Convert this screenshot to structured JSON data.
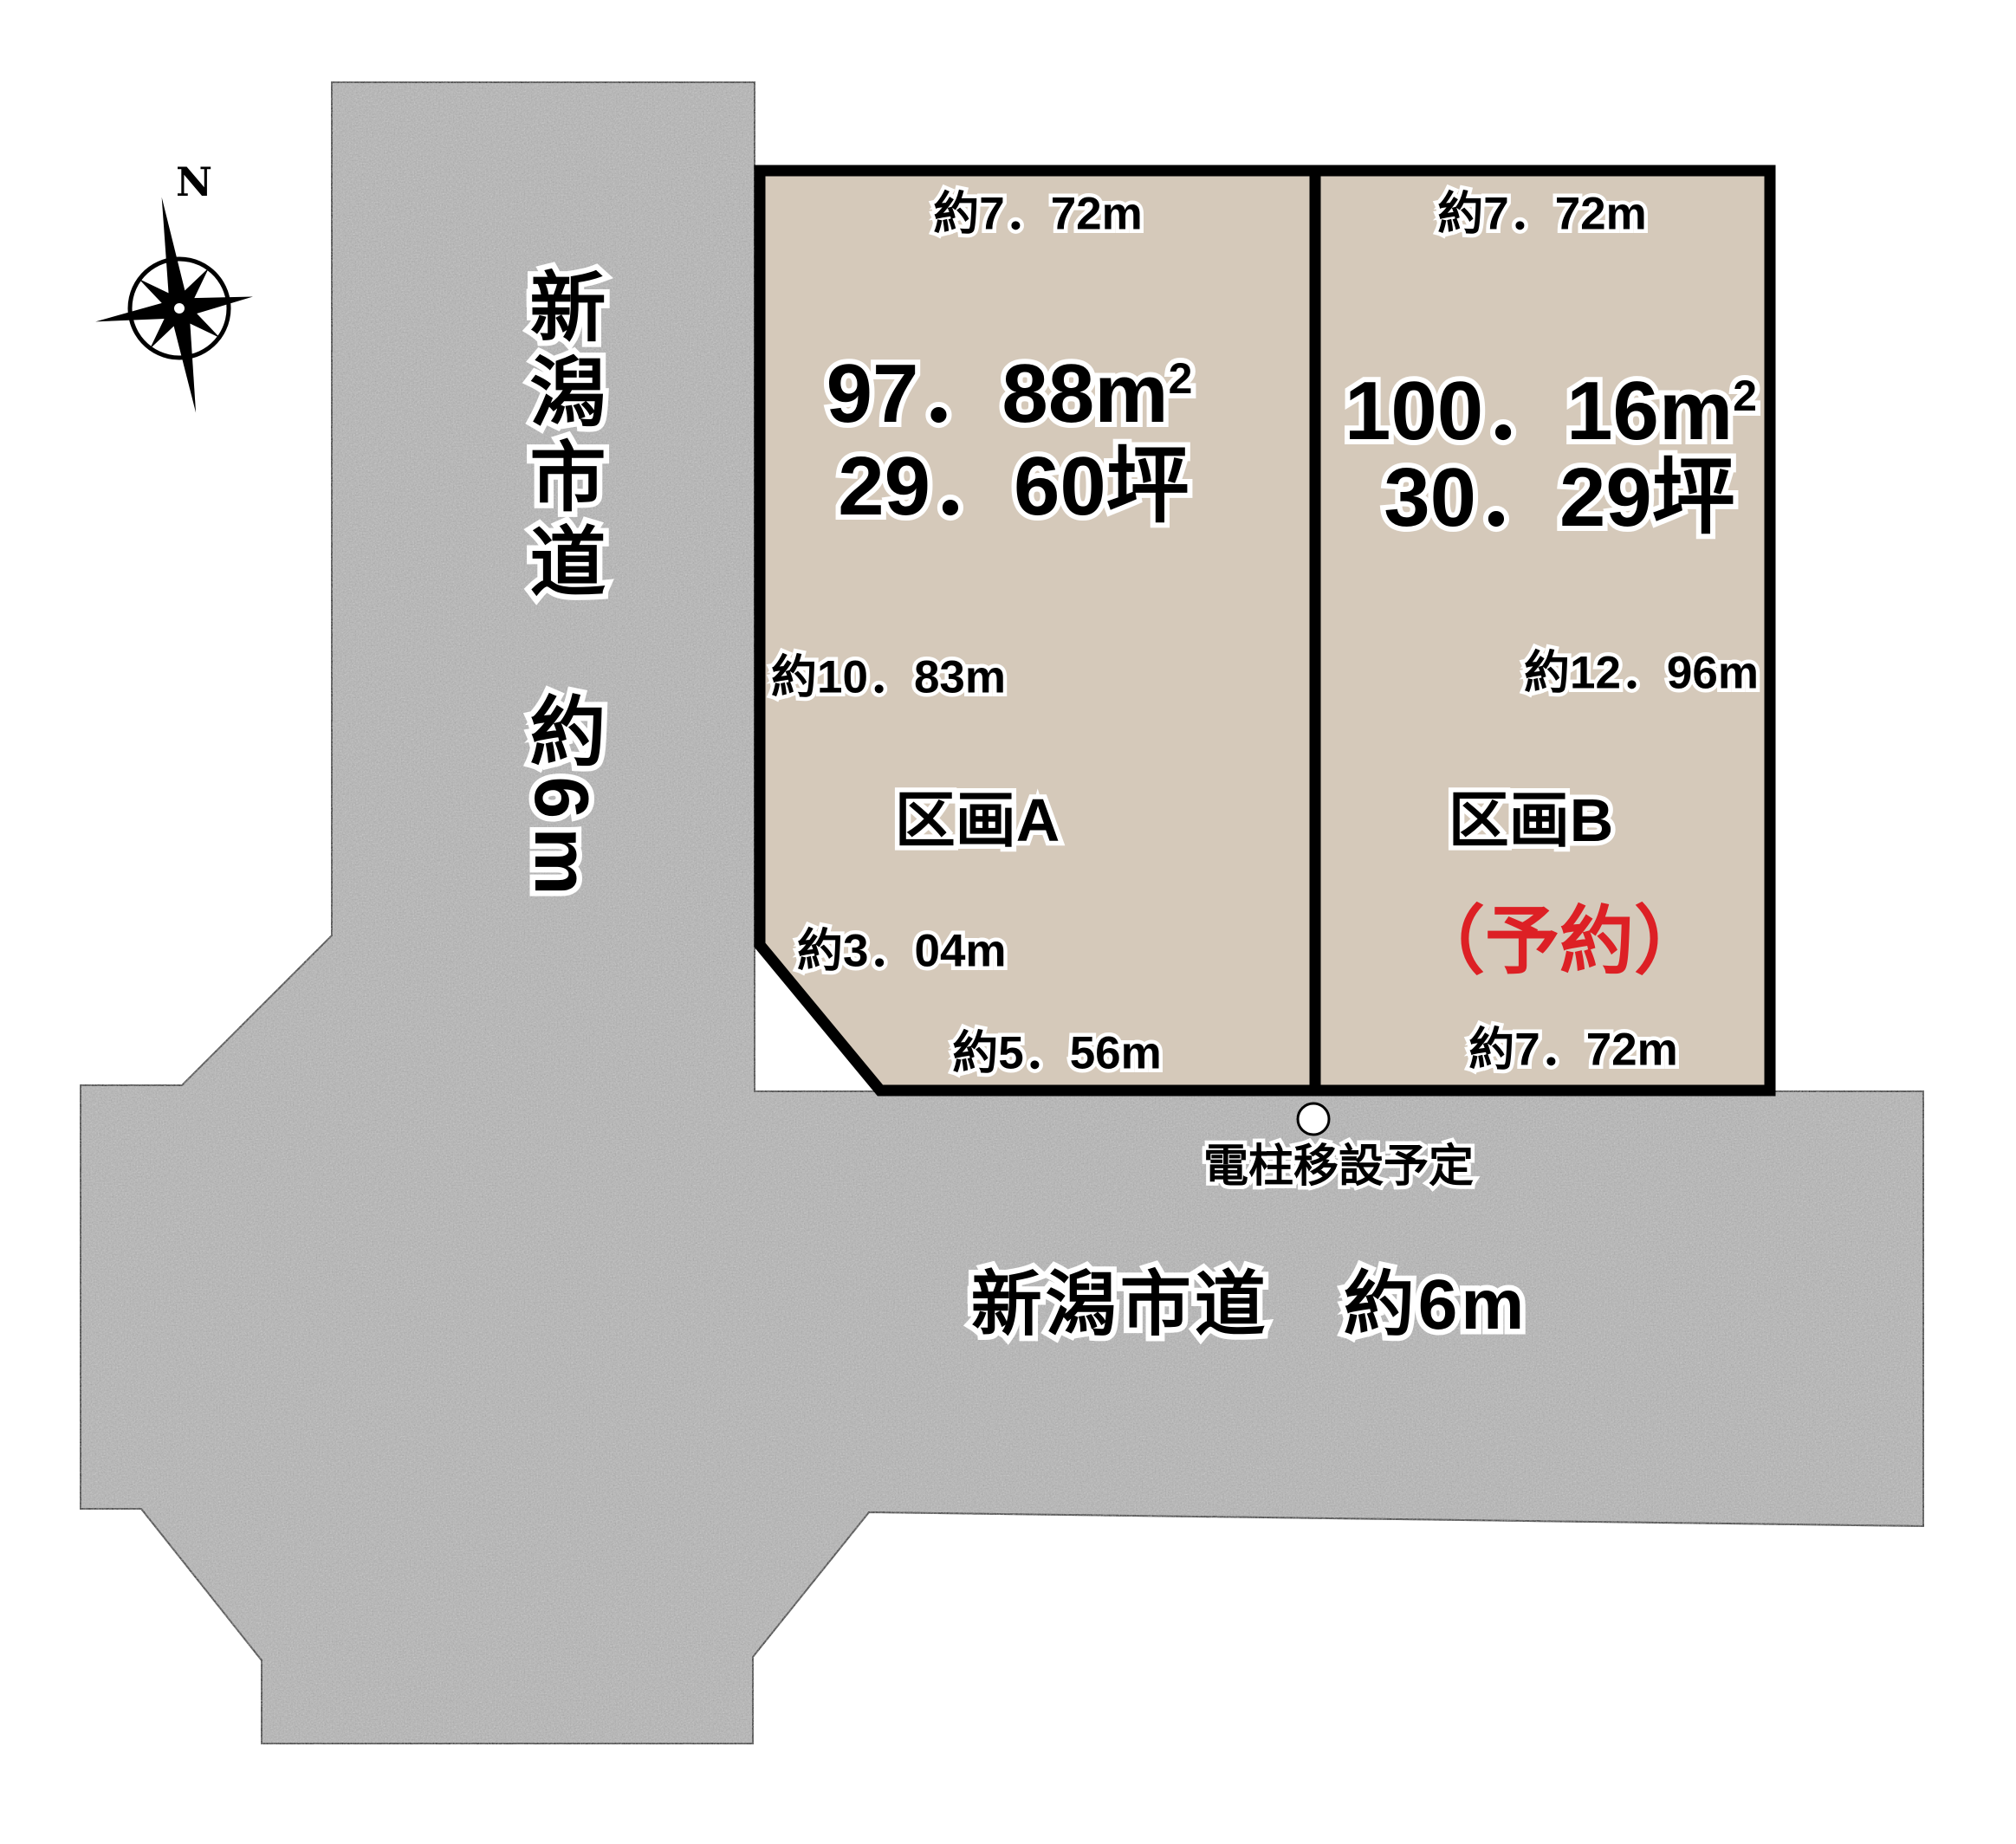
{
  "compass": {
    "north": "N"
  },
  "left_road": {
    "label": "新潟市道　約6m"
  },
  "bottom_road": {
    "label": "新潟市道　約6m"
  },
  "pole_note": {
    "label": "電柱移設予定"
  },
  "plot_a": {
    "name": "区画A",
    "area_m2": "97．88m",
    "area_m2_sup": "2",
    "area_tsubo": "29．60坪",
    "dim_top": "約7．72m",
    "dim_left": "約10．83m",
    "dim_corner": "約3．04m",
    "dim_bottom": "約5．56m"
  },
  "plot_b": {
    "name": "区画B",
    "status": "（予約）",
    "area_m2": "100．16m",
    "area_m2_sup": "2",
    "area_tsubo": "30．29坪",
    "dim_top": "約7．72m",
    "dim_right": "約12．96m",
    "dim_bottom": "約7．72m"
  },
  "colors": {
    "road_fill": "#a8a8a8",
    "plot_fill": "#d5c9ba",
    "reserved_red": "#dd2025",
    "line_black": "#000000"
  }
}
